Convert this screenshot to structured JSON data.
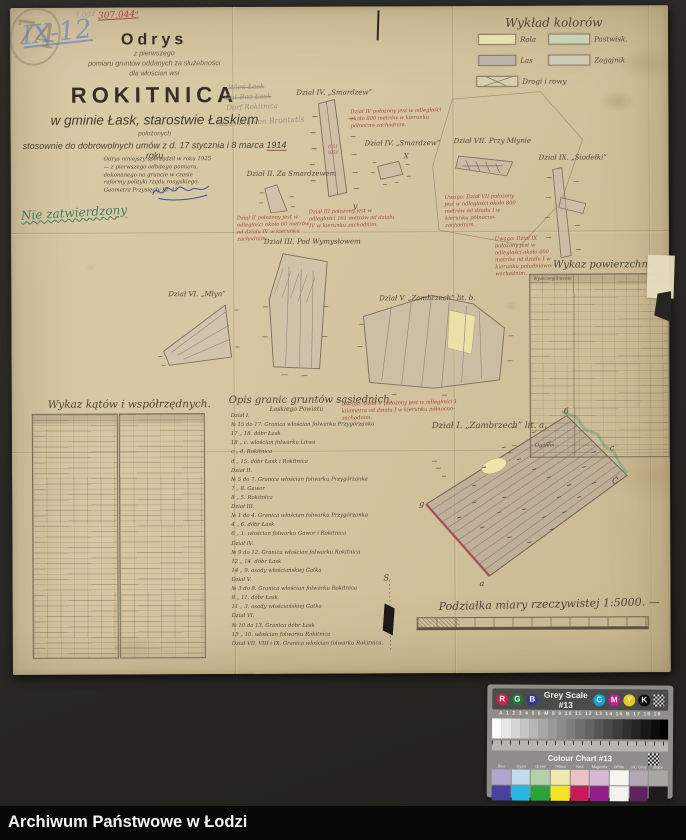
{
  "archive_bar": {
    "label": "Archiwum Państwowe w Łodzi"
  },
  "corner": {
    "inventory_mark": "IX-12",
    "ref_number": "307.044ᵃ",
    "stamp": "Łódź",
    "pencil_mark": "74"
  },
  "title_block": {
    "heading": "Odrys",
    "sub1": "z pierwszego",
    "sub2": "pomiaru gruntów oddanych za służebności",
    "sub3": "dla włościan wsi",
    "village": "ROKITNICA",
    "gmina_line": "w gminie Łask, starostwie Łaskiem",
    "positioned": "położonych",
    "agreement_pre": "stosownie do dobrowolnych umów z d. 17 stycznia i 8 marca ",
    "agreement_year": "1914",
    "agreement_post": " roku"
  },
  "pencil_notes": {
    "line1": "Wieś Łask",
    "line2": "Gut Bez Łask",
    "line3": "Dorf Rokitnica",
    "line4": "Messung von Brontatis"
  },
  "certification": {
    "line1": "Odrys niniejszy sporządził w roku 1925 —",
    "line2": "z pierwszego odbitego pomiaru, dokonanego na",
    "line3": "gruncie w czasie reformy polityki rządu rosyjskiego.",
    "signer": "Geometra Przysięgły Kl. 1°"
  },
  "approval_note": "Nie zatwierdzony",
  "legend": {
    "title": "Wykład kolorów",
    "items": [
      {
        "label": "Rola",
        "color": "#e9dfae"
      },
      {
        "label": "Pastwisk.",
        "color": "#c9d2b4"
      },
      {
        "label": "Las",
        "color": "#bcb6a8"
      },
      {
        "label": "Zagajnik",
        "color": "#cdccb6"
      },
      {
        "label": "Drogi i rowy",
        "color": "#d9cfae"
      }
    ]
  },
  "parcels": {
    "smardzew_top": {
      "label": "Dział IV. „Smardzew”"
    },
    "smardzew_right": {
      "label": "Dział IV. „Smardzew”"
    },
    "za_smardzewem": {
      "label": "Dział II. Za Smardzewem"
    },
    "pod_wymyslowem": {
      "label": "Dział III. Pod Wymysłowem"
    },
    "mlyn": {
      "label": "Dział VI. „Młyn”"
    },
    "zambrzech_b": {
      "label": "Dział V. „Zambrzech” lit. b."
    },
    "przy_mlynie": {
      "label": "Dział VII. Przy Młynie"
    },
    "siodelki": {
      "label": "Dział IX. „Siodełki”"
    },
    "zambrzech_a": {
      "label": "Dział I. „Zambrzech” lit. a."
    }
  },
  "red_notes": [
    {
      "text": "Dział IV położony jest w odległości około 800 metrów w kierunku północno-zachodnim."
    },
    {
      "text": "Dział II położony jest w odległości około 60 metrów od działu IV w kierunku zachodnim."
    },
    {
      "text": "Dział III położony jest w odległości 161 metrów od działu IV w kierunku zachodnim."
    },
    {
      "text": "Uwaga: Dział VII położony jest w odległości około 800 metrów od działu I w kierunku północno-zachodnim."
    },
    {
      "text": "Uwaga: Dział IX położony jest w odległości około 400 metrów od działu I w kierunku południowo-wschodnim."
    },
    {
      "text": "Uwaga: Dział V położony jest w odległości 1 kilometra od działu I w kierunku północno-zachodnim."
    }
  ],
  "map_letters": {
    "b": "б",
    "c": "c",
    "c2": "Ć",
    "g": "g",
    "a": "a",
    "x": "X",
    "y": "y",
    "s": "S"
  },
  "strip_numbers": {
    "n1": "1051",
    "n2": "1052"
  },
  "tables": {
    "angles": {
      "title": "Wykaz kątów i współrzędnych."
    },
    "areas": {
      "title": "Wykaz powierzchni.",
      "header": "Wyszczególnienie",
      "total_label": "Ogółem"
    },
    "borders": {
      "title": "Opis granic gruntów sąsiednich.",
      "subtitle": "Łaskiego Powiatu",
      "lines": [
        "Dział I.",
        "№ 15 do 17. Granica włościan folwarku Przygórzanka",
        "17 „ 18. dóbr Łask",
        "18 „ c. włościan folwarku Litwa",
        "c „ d. Rokitnica",
        "d „ 15. dóbr Łask i Rokitnica",
        "Dział II.",
        "№ 5 do 7. Granica włościan folwarku Przygórzanka",
        "7 „ 8. Gawor",
        "8 „ 5. Rokitnica",
        "Dział III.",
        "№ 1 do 4. Granica włościan folwarku Przygórzanka",
        "4 „ 6. dóbr Łask",
        "6 „ 1. włościan folwarku Gawor i Rokitnica",
        "Dział IV.",
        "№ 9 do 12. Granica włościan folwarku Rokitnica",
        "12 „ 14. dóbr Łask",
        "14 „ 9. osady włościańskiej Gatka",
        "Dział V.",
        "№ 3 do 8. Granica włościan folwarku Rokitnica",
        "8 „ 11. dóbr Łask",
        "11 „ 3. osady włościańskiej Gatka",
        "Dział VI.",
        "№ 10 do 13. Granica dóbr Łask",
        "13 „ 10. włościan folwarku Rokitnica",
        "Dział VII, VIII i IX. Granica włościan folwarku Rokitnica."
      ]
    }
  },
  "scale": {
    "label": "Podziałka miary rzeczywistej 1:5000. —"
  },
  "calibration_card": {
    "grey_scale_title": "Grey Scale #13",
    "colour_chart_title": "Colour Chart #13",
    "rgb_letters": [
      "R",
      "G",
      "B"
    ],
    "rgb_colors": [
      "#c02a48",
      "#26743c",
      "#37378e"
    ],
    "cmyk_letters": [
      "C",
      "M",
      "Y",
      "K"
    ],
    "cmyk_colors": [
      "#12a3d8",
      "#bf2090",
      "#e0cc1d",
      "#0e0e0e"
    ],
    "index_row": "A 1 2 3 4 5 6 M 8 9 10 11 12 13 14 15 B 17 18 19",
    "grey_steps": 19,
    "color_labels": [
      "Blue",
      "Cyan",
      "Green",
      "Yellow",
      "Red",
      "Magenta",
      "White",
      "3/C Grey",
      "Black"
    ],
    "swatches_pastel": [
      "#b0a6ce",
      "#c3dcea",
      "#b5cfa8",
      "#f0eab2",
      "#edc0c4",
      "#d8b9d5",
      "#f6f4ef",
      "#b3a6b5",
      "#a9a6a4"
    ],
    "swatches_saturated": [
      "#4841a0",
      "#29b7e3",
      "#2ba33c",
      "#f2e425",
      "#c81a56",
      "#8f1f8a",
      "#f4f2ed",
      "#5c2560",
      "#1c1b1a"
    ]
  }
}
